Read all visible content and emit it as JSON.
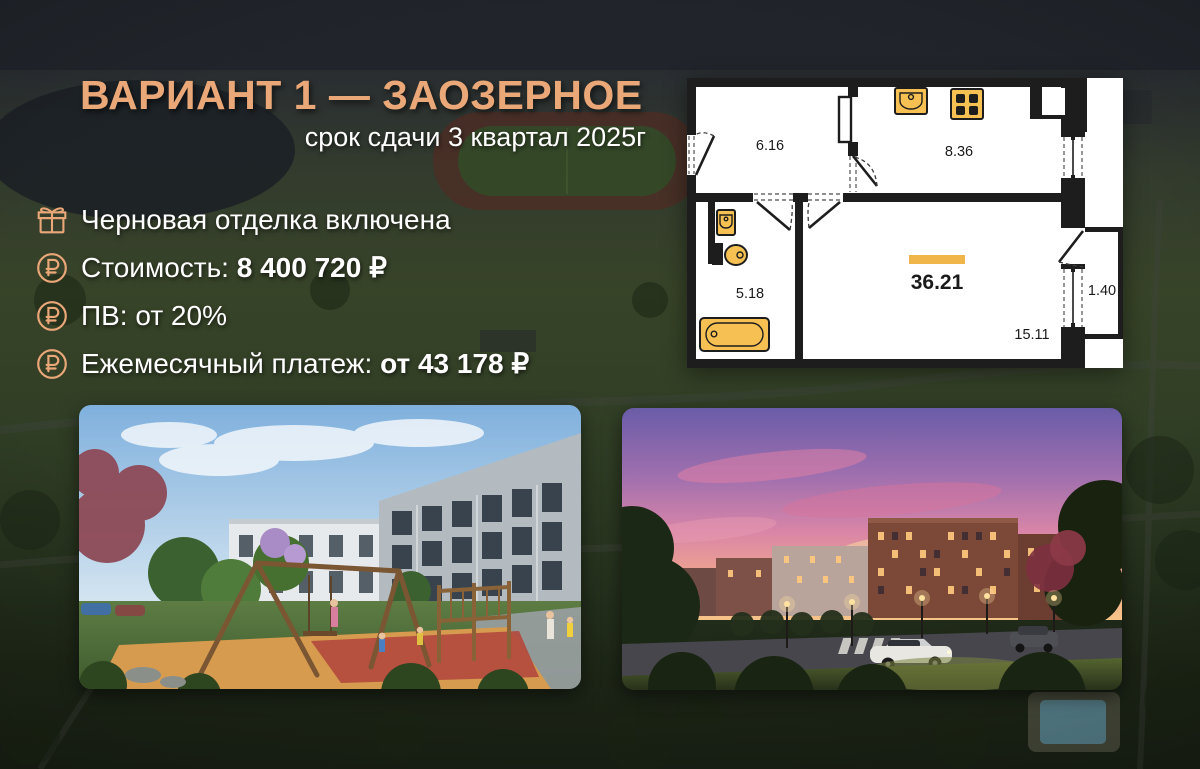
{
  "header": {
    "title": "ВАРИАНТ 1 — ЗАОЗЕРНОЕ",
    "subtitle": "срок сдачи 3 квартал 2025г"
  },
  "features": [
    {
      "icon": "gift-icon",
      "text": "Черновая отделка включена",
      "bold": ""
    },
    {
      "icon": "ruble-circle-icon",
      "text": "Стоимость: ",
      "bold": "8 400 720 ₽"
    },
    {
      "icon": "ruble-circle-icon",
      "text": "ПВ: от 20%",
      "bold": ""
    },
    {
      "icon": "ruble-circle-icon",
      "text": "Ежемесячный платеж: ",
      "bold": "от 43 178 ₽"
    }
  ],
  "floor_plan": {
    "total_area": "36.21",
    "rooms": {
      "hallway": "6.16",
      "kitchen": "8.36",
      "bathroom": "5.18",
      "living_room": "15.11",
      "balcony": "1.40"
    }
  },
  "colors": {
    "accent": "#EAA878",
    "plan_accent_bar": "#F0B64A",
    "plan_fixtures": "#F6C152",
    "plan_walls": "#1D1D1D",
    "text": "#FFFFFF"
  }
}
